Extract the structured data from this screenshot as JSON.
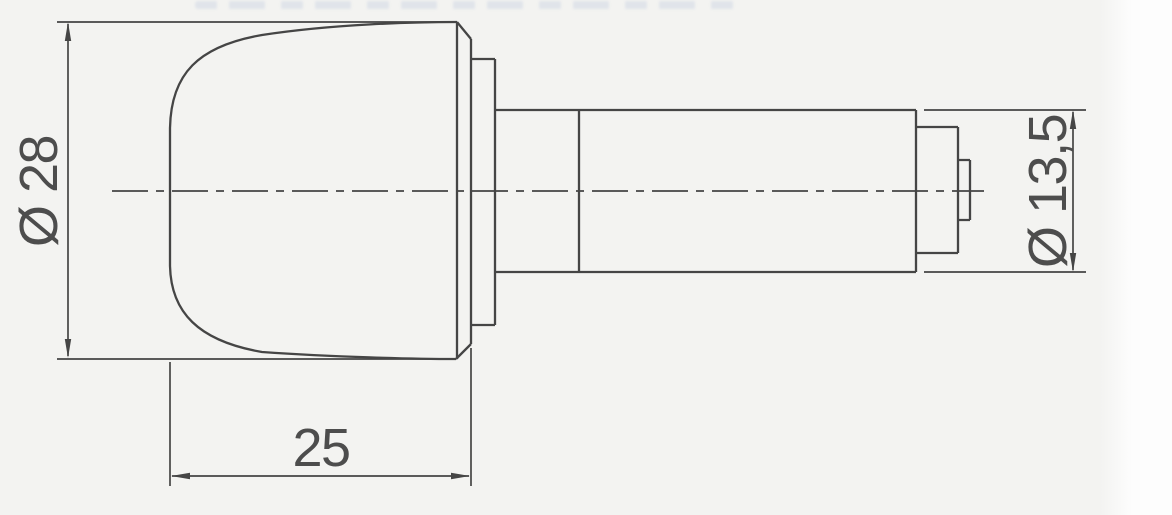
{
  "page": {
    "background_color": "#f3f3f1",
    "margin_color": "#fdfdfd",
    "line_color": "#454545",
    "text_color": "#4d4d4d",
    "artifact_color": "#c3cde0"
  },
  "drawing": {
    "dimensions": {
      "cap_diameter": {
        "label": "Ø 28",
        "symbol": "Ø",
        "value": "28",
        "orientation": "vertical-left"
      },
      "cap_length": {
        "label": "25",
        "value": "25",
        "orientation": "horizontal-bottom"
      },
      "end_diameter": {
        "label": "Ø 13,5",
        "symbol": "Ø",
        "value": "13,5",
        "orientation": "vertical-right"
      }
    },
    "centerline_style": "dash-dot"
  }
}
